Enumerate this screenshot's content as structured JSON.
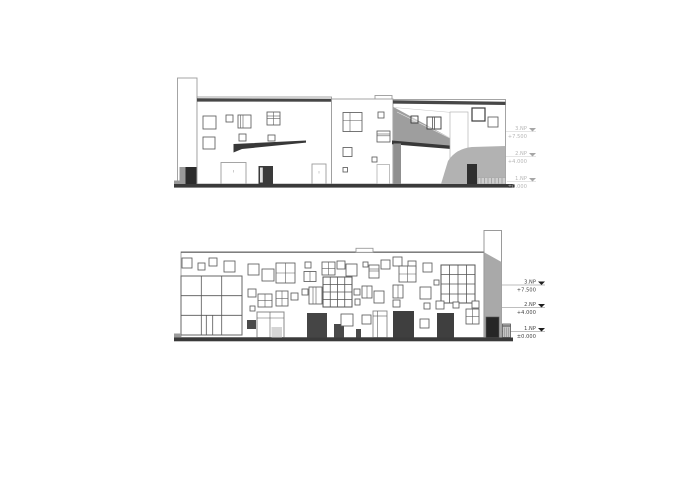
{
  "sheet": {
    "type": "architectural-elevation-drawing",
    "background": "#ffffff"
  },
  "top_elevation": {
    "levels": [
      {
        "label": "3.NP",
        "value": "+7.500"
      },
      {
        "label": "2.NP",
        "value": "+4.000"
      },
      {
        "label": "1.NP",
        "value": "±0.000"
      }
    ],
    "label_color": "#b5b5b5"
  },
  "bottom_elevation": {
    "levels": [
      {
        "label": "3.NP",
        "value": "+7.500"
      },
      {
        "label": "2.NP",
        "value": "+4.000"
      },
      {
        "label": "1.NP",
        "value": "±0.000"
      }
    ],
    "label_color": "#3f3f3f"
  },
  "colors": {
    "roof_band": "#474747",
    "ground": "#3a3a3a",
    "canopy": "#383838",
    "shadow_gray": "#9e9e9e",
    "hill_gray": "#b2b2b2",
    "tower_gray": "#a9a9a9",
    "column_gray": "#8f8f8f",
    "door_dark": "#3f3f3f"
  }
}
